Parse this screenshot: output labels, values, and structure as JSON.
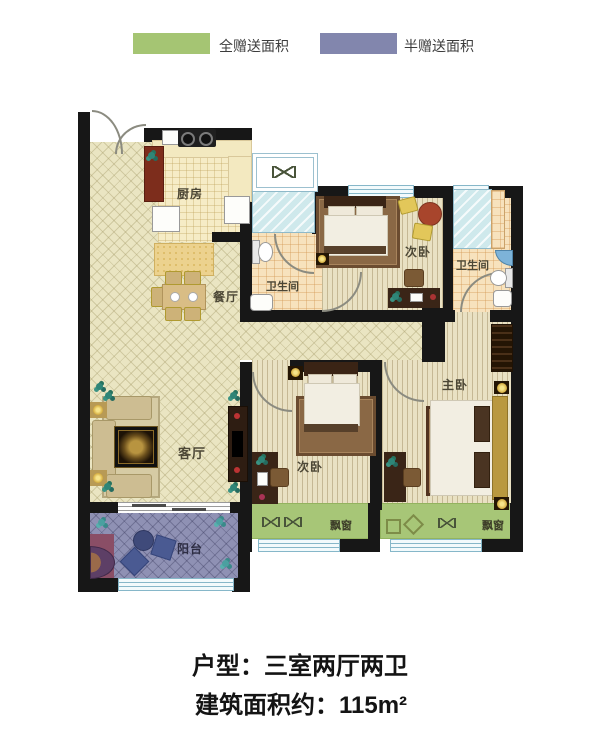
{
  "legend": {
    "items": [
      {
        "label": "全赠送面积",
        "color": "#a5c573"
      },
      {
        "label": "半赠送面积",
        "color": "#8286ad"
      }
    ]
  },
  "plan": {
    "rooms": {
      "kitchen": {
        "label": "厨房"
      },
      "dining": {
        "label": "餐厅"
      },
      "living": {
        "label": "客厅"
      },
      "balcony": {
        "label": "阳台"
      },
      "bath1": {
        "label": "卫生间"
      },
      "bath2": {
        "label": "卫生间"
      },
      "bedroom_top": {
        "label": "次卧"
      },
      "bedroom_bottom": {
        "label": "次卧"
      },
      "master": {
        "label": "主卧"
      }
    },
    "bay_windows": [
      {
        "label": "飘窗"
      },
      {
        "label": "飘窗"
      }
    ]
  },
  "footer": {
    "line1": "户型：三室两厅两卫",
    "line2": "建筑面积约：115m²"
  }
}
